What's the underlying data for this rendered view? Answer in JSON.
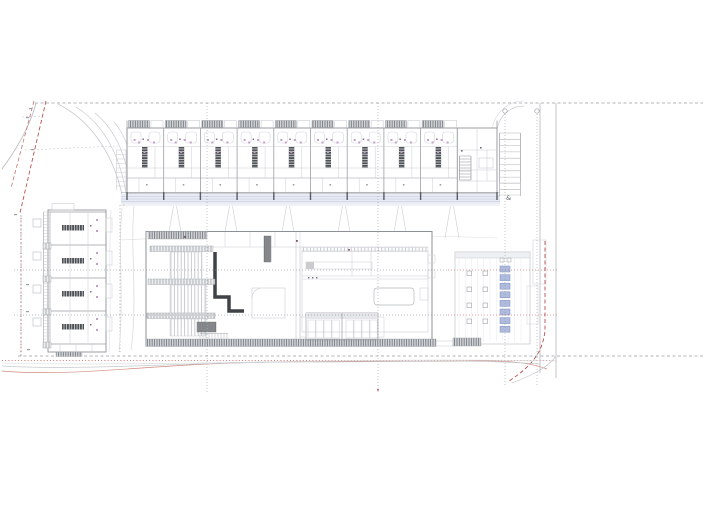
{
  "drawing": {
    "labels": {
      "accessible_marker": "&"
    },
    "counts": {
      "top_row_units": 9,
      "top_row_end_units": 1,
      "west_row_units": 4,
      "east_parking_stalls": 10,
      "pavilion_column_rows": 4,
      "pavilion_column_cols": 2,
      "pavilion_equipment_items": 8,
      "pool_stall_cells_per_bay": 4,
      "pool_stall_bays": 2,
      "grid_bubbles": 2
    },
    "colors": {
      "paper": "#ffffff",
      "line_light": "#c9ccd1",
      "line_mid": "#9b9ea3",
      "line_dark": "#6f7276",
      "wall_dark": "#3f4246",
      "stair_dark": "#4e5155",
      "hatch_bg": "#d2d5d9",
      "hatch_line": "#75787c",
      "accent_magenta": "#c39fca",
      "accent_magenta_dark": "#8a6b90",
      "walkway_fill": "#e9ecf5",
      "walkway_line": "#bcc4da",
      "pavilion_blue_fill": "#aebbdc",
      "pavilion_blue_line": "#7e92c0",
      "red_dash": "#b9524e",
      "red_dot": "#c0504d",
      "contour_red": "#cf8a7f",
      "grid_gray": "#8f9297",
      "boundary_gray": "#9a9da2",
      "curve_gray": "#c6c9cd"
    }
  }
}
